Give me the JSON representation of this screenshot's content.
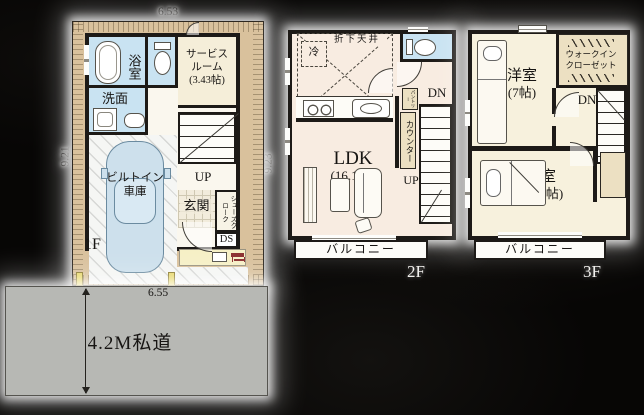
{
  "colors": {
    "background": "#070605",
    "site_tan": "#d9c19c",
    "room_cream": "#f5eed9",
    "room_pink": "#f8ece1",
    "wet_blue": "#c9e3f2",
    "wall": "#1d1a17",
    "road_gray": "#b7b8b4",
    "closet_tan": "#ece0c2",
    "car_blue": "#cde0ec"
  },
  "floor1": {
    "floor_label": "1F",
    "dim_top": "6.53",
    "dim_left": "9.21",
    "dim_right": "9.23",
    "bath": "浴室",
    "washroom": "洗面",
    "service_room": [
      "サービス",
      "ルーム",
      "(3.43帖)"
    ],
    "garage": [
      "ビルトイン",
      "車庫"
    ],
    "entrance": "玄関",
    "shoe_closet": "シューズクローク",
    "duct_space": "DS",
    "stairs_up": "UP"
  },
  "floor2": {
    "floor_label": "2F",
    "ldk": [
      "LDK",
      "(16.12帖)"
    ],
    "dropped_ceiling": "折下天井",
    "refrigerator": "冷",
    "counter": "カウンター",
    "pantry": "パントリー",
    "stairs_dn": "DN",
    "stairs_up": "UP",
    "balcony": "バルコニー"
  },
  "floor3": {
    "floor_label": "3F",
    "bedroom_a": [
      "洋室",
      "(7帖)"
    ],
    "bedroom_b": [
      "洋室",
      "(7.87帖)"
    ],
    "walk_in_closet": [
      "ウォークイン",
      "クローゼット"
    ],
    "stairs_dn": "DN",
    "balcony": "バルコニー"
  },
  "road": {
    "label": "4.2M私道",
    "dim_top": "6.55"
  }
}
